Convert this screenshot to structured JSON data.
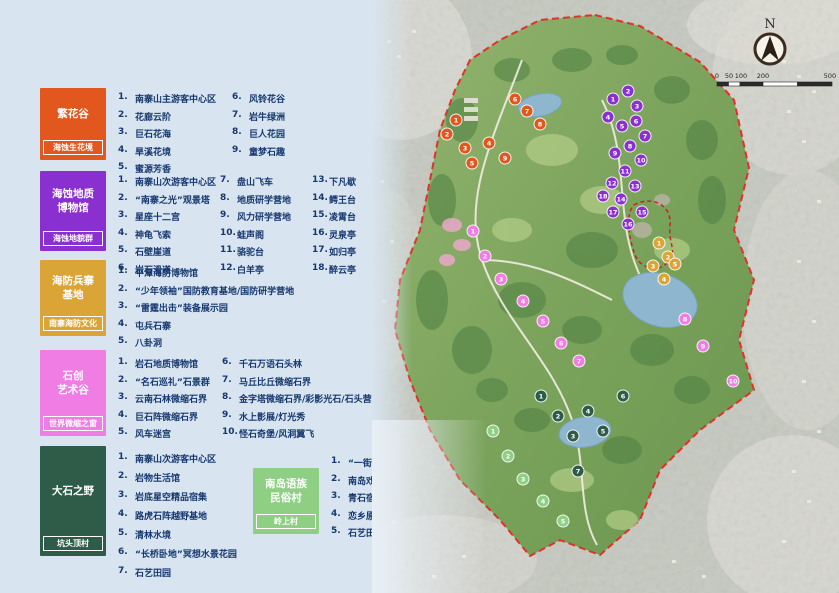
{
  "legend": {
    "sections": [
      {
        "title": "繁花谷",
        "tag": "海蚀生花境",
        "color": "#e2571d",
        "columns": [
          [
            {
              "n": "1.",
              "t": "南寨山主游客中心区"
            },
            {
              "n": "2.",
              "t": "花廊云阶"
            },
            {
              "n": "3.",
              "t": "巨石花海"
            },
            {
              "n": "4.",
              "t": "旱溪花境"
            },
            {
              "n": "5.",
              "t": "蜜源芳香"
            }
          ],
          [
            {
              "n": "6.",
              "t": "风铃花谷"
            },
            {
              "n": "7.",
              "t": "岩牛绿洲"
            },
            {
              "n": "8.",
              "t": "巨人花园"
            },
            {
              "n": "9.",
              "t": "童梦石趣"
            }
          ]
        ]
      },
      {
        "title": "海蚀地质\n博物馆",
        "tag": "海蚀地貌群",
        "color": "#8a2fd0",
        "columns": [
          [
            {
              "n": "1.",
              "t": "南寨山次游客中心区"
            },
            {
              "n": "2.",
              "t": "“南寨之光”观景塔"
            },
            {
              "n": "3.",
              "t": "星座十二宫"
            },
            {
              "n": "4.",
              "t": "神龟飞索"
            },
            {
              "n": "5.",
              "t": "石壁崖道"
            },
            {
              "n": "6.",
              "t": "岩石滑道"
            }
          ],
          [
            {
              "n": "7.",
              "t": "盘山飞车"
            },
            {
              "n": "8.",
              "t": "地质研学营地"
            },
            {
              "n": "9.",
              "t": "风力研学营地"
            },
            {
              "n": "10.",
              "t": "蛙声阁"
            },
            {
              "n": "11.",
              "t": "骆驼台"
            },
            {
              "n": "12.",
              "t": "白羊亭"
            }
          ],
          [
            {
              "n": "13.",
              "t": "下凡歇"
            },
            {
              "n": "14.",
              "t": "鳄王台"
            },
            {
              "n": "15.",
              "t": "凌霄台"
            },
            {
              "n": "16.",
              "t": "灵泉亭"
            },
            {
              "n": "17.",
              "t": "如归亭"
            },
            {
              "n": "18.",
              "t": "醉云亭"
            }
          ]
        ]
      },
      {
        "title": "海防兵寨\n基地",
        "tag": "南寨海防文化",
        "color": "#daa437",
        "columns": [
          [
            {
              "n": "1.",
              "t": "平潭海防博物馆"
            },
            {
              "n": "2.",
              "t": "“少年领袖”国防教育基地/国防研学营地"
            },
            {
              "n": "3.",
              "t": "“雷霆出击”装备展示园"
            },
            {
              "n": "4.",
              "t": "屯兵石寨"
            },
            {
              "n": "5.",
              "t": "八卦洞"
            }
          ]
        ]
      },
      {
        "title": "石创\n艺术谷",
        "tag": "世界微缩之窗",
        "color": "#ef7de4",
        "columns": [
          [
            {
              "n": "1.",
              "t": "岩石地质博物馆"
            },
            {
              "n": "2.",
              "t": "“名石巡礼”石景群"
            },
            {
              "n": "3.",
              "t": "云南石林微缩石界"
            },
            {
              "n": "4.",
              "t": "巨石阵微缩石界"
            },
            {
              "n": "5.",
              "t": "风车迷宫"
            }
          ],
          [
            {
              "n": "6.",
              "t": "千石万语石头林"
            },
            {
              "n": "7.",
              "t": "马丘比丘微缩石界"
            },
            {
              "n": "8.",
              "t": "金字塔微缩石界/彩影光石/石头营地"
            },
            {
              "n": "9.",
              "t": "水上影展/灯光秀"
            },
            {
              "n": "10.",
              "t": "怪石奇堡/风洞翼飞"
            }
          ]
        ]
      },
      {
        "title": "大石之野",
        "tag": "坑头顶村",
        "color": "#2e5c49",
        "columns": [
          [
            {
              "n": "1.",
              "t": "南寨山次游客中心区"
            },
            {
              "n": "2.",
              "t": "岩物生活馆"
            },
            {
              "n": "3.",
              "t": "岩底星空精品宿集"
            },
            {
              "n": "4.",
              "t": "路虎石阵越野基地"
            },
            {
              "n": "5.",
              "t": "清林水境"
            },
            {
              "n": "6.",
              "t": "“长桥卧地”冥想水景花园"
            },
            {
              "n": "7.",
              "t": "石艺田园"
            }
          ]
        ]
      },
      {
        "title": "南岛语族\n民俗村",
        "tag": "岭上村",
        "color": "#8ecf83",
        "columns": [
          [
            {
              "n": "1.",
              "t": "“一街两巷”南语文化街"
            },
            {
              "n": "2.",
              "t": "南岛戏台"
            },
            {
              "n": "3.",
              "t": "青石宿集"
            },
            {
              "n": "4.",
              "t": "恋乡原舍"
            },
            {
              "n": "5.",
              "t": "石艺田园"
            }
          ]
        ]
      }
    ]
  },
  "map": {
    "north_label": "N",
    "scale_ticks": [
      "0",
      "50",
      "100",
      "200",
      "500"
    ],
    "boundary_color": "#e0312a",
    "markers": [
      {
        "s": 0,
        "n": 1,
        "x": 84,
        "y": 120
      },
      {
        "s": 0,
        "n": 2,
        "x": 75,
        "y": 134
      },
      {
        "s": 0,
        "n": 3,
        "x": 93,
        "y": 148
      },
      {
        "s": 0,
        "n": 4,
        "x": 117,
        "y": 143
      },
      {
        "s": 0,
        "n": 5,
        "x": 100,
        "y": 163
      },
      {
        "s": 0,
        "n": 6,
        "x": 143,
        "y": 99
      },
      {
        "s": 0,
        "n": 7,
        "x": 155,
        "y": 111
      },
      {
        "s": 0,
        "n": 8,
        "x": 168,
        "y": 124
      },
      {
        "s": 0,
        "n": 9,
        "x": 133,
        "y": 158
      },
      {
        "s": 1,
        "n": 1,
        "x": 241,
        "y": 99
      },
      {
        "s": 1,
        "n": 2,
        "x": 256,
        "y": 91
      },
      {
        "s": 1,
        "n": 3,
        "x": 265,
        "y": 106
      },
      {
        "s": 1,
        "n": 4,
        "x": 236,
        "y": 117
      },
      {
        "s": 1,
        "n": 5,
        "x": 250,
        "y": 126
      },
      {
        "s": 1,
        "n": 6,
        "x": 264,
        "y": 121
      },
      {
        "s": 1,
        "n": 7,
        "x": 273,
        "y": 136
      },
      {
        "s": 1,
        "n": 8,
        "x": 258,
        "y": 146
      },
      {
        "s": 1,
        "n": 9,
        "x": 243,
        "y": 153
      },
      {
        "s": 1,
        "n": 10,
        "x": 269,
        "y": 160
      },
      {
        "s": 1,
        "n": 11,
        "x": 253,
        "y": 171
      },
      {
        "s": 1,
        "n": 12,
        "x": 240,
        "y": 183
      },
      {
        "s": 1,
        "n": 13,
        "x": 263,
        "y": 186
      },
      {
        "s": 1,
        "n": 14,
        "x": 249,
        "y": 199
      },
      {
        "s": 1,
        "n": 15,
        "x": 270,
        "y": 212
      },
      {
        "s": 1,
        "n": 16,
        "x": 256,
        "y": 224
      },
      {
        "s": 1,
        "n": 17,
        "x": 241,
        "y": 212
      },
      {
        "s": 1,
        "n": 18,
        "x": 231,
        "y": 196
      },
      {
        "s": 2,
        "n": 1,
        "x": 287,
        "y": 243
      },
      {
        "s": 2,
        "n": 2,
        "x": 296,
        "y": 257
      },
      {
        "s": 2,
        "n": 3,
        "x": 281,
        "y": 266
      },
      {
        "s": 2,
        "n": 4,
        "x": 292,
        "y": 279
      },
      {
        "s": 2,
        "n": 5,
        "x": 303,
        "y": 264
      },
      {
        "s": 3,
        "n": 1,
        "x": 101,
        "y": 231
      },
      {
        "s": 3,
        "n": 2,
        "x": 113,
        "y": 256
      },
      {
        "s": 3,
        "n": 3,
        "x": 129,
        "y": 279
      },
      {
        "s": 3,
        "n": 4,
        "x": 151,
        "y": 301
      },
      {
        "s": 3,
        "n": 5,
        "x": 171,
        "y": 321
      },
      {
        "s": 3,
        "n": 6,
        "x": 189,
        "y": 343
      },
      {
        "s": 3,
        "n": 7,
        "x": 207,
        "y": 361
      },
      {
        "s": 3,
        "n": 8,
        "x": 313,
        "y": 319
      },
      {
        "s": 3,
        "n": 9,
        "x": 331,
        "y": 346
      },
      {
        "s": 3,
        "n": 10,
        "x": 361,
        "y": 381
      },
      {
        "s": 4,
        "n": 1,
        "x": 169,
        "y": 396
      },
      {
        "s": 4,
        "n": 2,
        "x": 186,
        "y": 416
      },
      {
        "s": 4,
        "n": 3,
        "x": 201,
        "y": 436
      },
      {
        "s": 4,
        "n": 4,
        "x": 216,
        "y": 411
      },
      {
        "s": 4,
        "n": 5,
        "x": 231,
        "y": 431
      },
      {
        "s": 4,
        "n": 6,
        "x": 251,
        "y": 396
      },
      {
        "s": 4,
        "n": 7,
        "x": 206,
        "y": 471
      },
      {
        "s": 5,
        "n": 1,
        "x": 121,
        "y": 431
      },
      {
        "s": 5,
        "n": 2,
        "x": 136,
        "y": 456
      },
      {
        "s": 5,
        "n": 3,
        "x": 151,
        "y": 479
      },
      {
        "s": 5,
        "n": 4,
        "x": 171,
        "y": 501
      },
      {
        "s": 5,
        "n": 5,
        "x": 191,
        "y": 521
      }
    ]
  }
}
